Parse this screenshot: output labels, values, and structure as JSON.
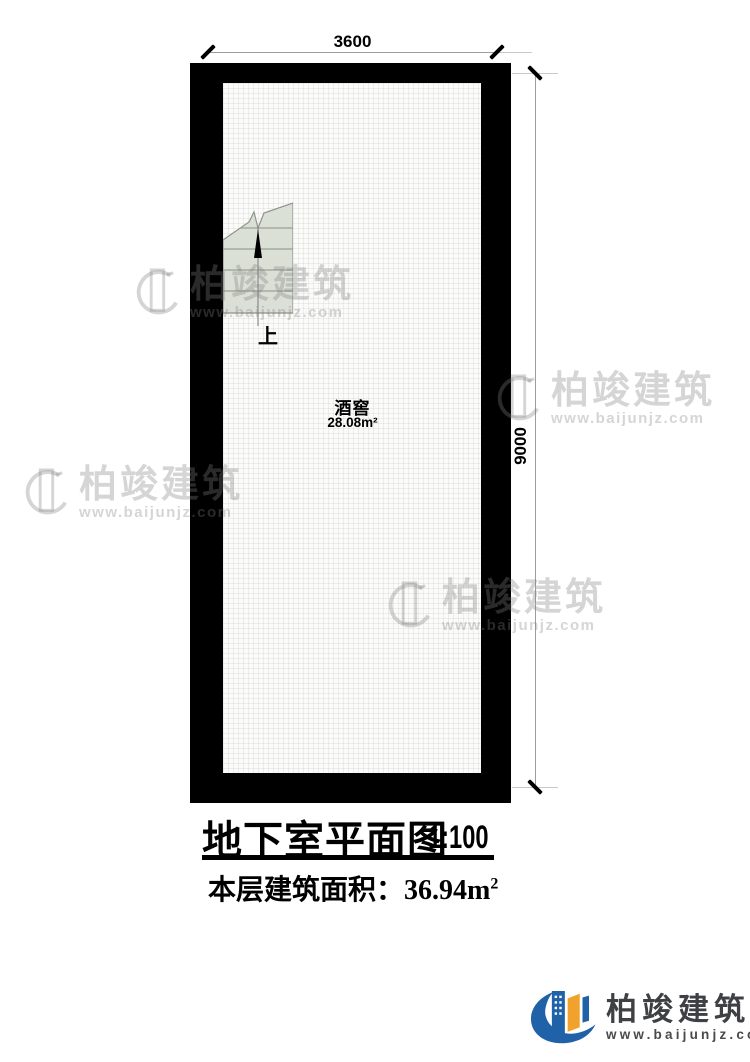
{
  "plan": {
    "room": {
      "name": "酒窖",
      "area": "28.08m²"
    },
    "stair_label": "上",
    "dimensions": {
      "width": "3600",
      "height": "9000"
    }
  },
  "title": {
    "main": "地下室平面图",
    "scale": "1:100",
    "area_label": "本层建筑面积：",
    "area_value": "36.94m",
    "area_sup": "2"
  },
  "watermark": {
    "brand": "柏竣建筑",
    "url": "www.baijunjz.com"
  },
  "footer_logo": {
    "brand": "柏竣建筑",
    "url": "www.baijunjz.com"
  },
  "colors": {
    "wall": "#000000",
    "floor": "#fbfbfa",
    "stair_fill": "#dbe0d7",
    "logo_blue": "#2062a8",
    "logo_orange": "#f0a22c",
    "logo_text": "#3f4043",
    "watermark_gray": "#8a8a8a"
  }
}
